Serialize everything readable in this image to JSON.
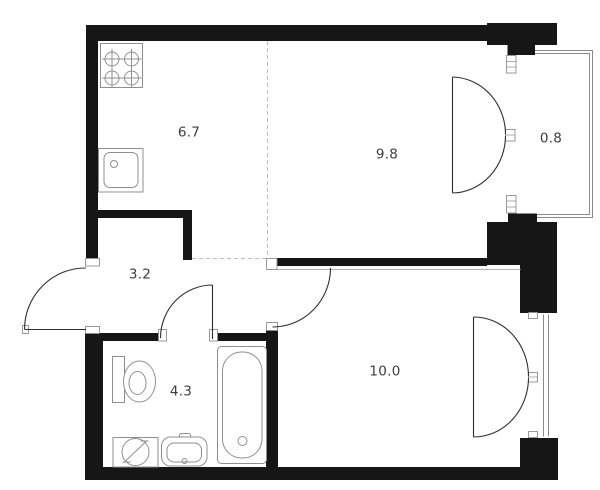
{
  "plan": {
    "title": "one-bedroom apartment floor plan",
    "rooms": [
      {
        "id": "kitchen",
        "area": "6.7"
      },
      {
        "id": "living-room",
        "area": "9.8"
      },
      {
        "id": "balcony",
        "area": "0.8"
      },
      {
        "id": "hallway",
        "area": "3.2"
      },
      {
        "id": "bathroom",
        "area": "4.3"
      },
      {
        "id": "bedroom",
        "area": "10.0"
      }
    ],
    "fixtures": [
      "stove",
      "kitchen-sink",
      "toilet",
      "washing-machine",
      "bathroom-sink",
      "bathtub"
    ],
    "doors": [
      "entrance-door",
      "bathroom-door",
      "bedroom-door",
      "balcony-french-door",
      "bedroom-french-door"
    ],
    "windows": [
      "balcony-glazing",
      "bedroom-window"
    ],
    "colors": {
      "wall": "#161616",
      "fixture_stroke": "#8f8f8f",
      "door_stroke": "#2f2f2f",
      "label": "#3d3d3d",
      "dashed_line": "#bdbdbd",
      "background": "#ffffff"
    }
  }
}
